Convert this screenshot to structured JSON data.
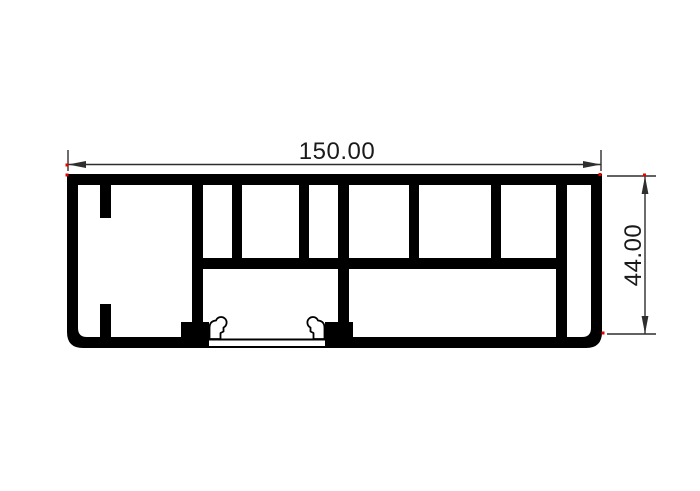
{
  "page": {
    "background": "#ffffff"
  },
  "drawing": {
    "kind": "aluminium-extrusion-profile-cross-section",
    "dimensions": {
      "width": {
        "label": "150.00"
      },
      "height": {
        "label": "44.00"
      }
    },
    "colors": {
      "line": "#000000",
      "dim": "#2e2e2e",
      "text": "#1a1a1a",
      "defpoint": "#e60000",
      "background": "#ffffff"
    }
  }
}
